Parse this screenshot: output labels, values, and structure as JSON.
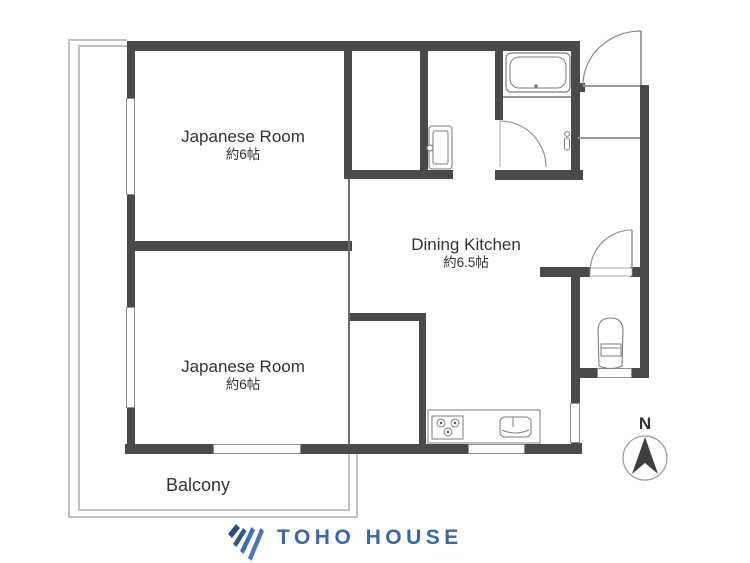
{
  "plan": {
    "rooms": [
      {
        "id": "japanese-room-1",
        "label": "Japanese Room",
        "area": "約6帖"
      },
      {
        "id": "japanese-room-2",
        "label": "Japanese Room",
        "area": "約6帖"
      },
      {
        "id": "dining-kitchen",
        "label": "Dining Kitchen",
        "area": "約6.5帖"
      },
      {
        "id": "balcony",
        "label": "Balcony"
      }
    ],
    "fixtures": [
      "bathtub",
      "washing-machine-pan",
      "toilet",
      "stove",
      "kitchen-sink",
      "entrance-door",
      "bathroom-door",
      "toilet-door"
    ],
    "compass": {
      "label": "N"
    },
    "colors": {
      "wall": "#4a4a4a",
      "fixture_line": "#808080",
      "balcony_line": "#bfbfbf",
      "text": "#333333"
    }
  },
  "branding": {
    "logo_text": "TOHO HOUSE",
    "logo_color": "#3a67a5",
    "logo_icon": "toho-wing-icon"
  }
}
